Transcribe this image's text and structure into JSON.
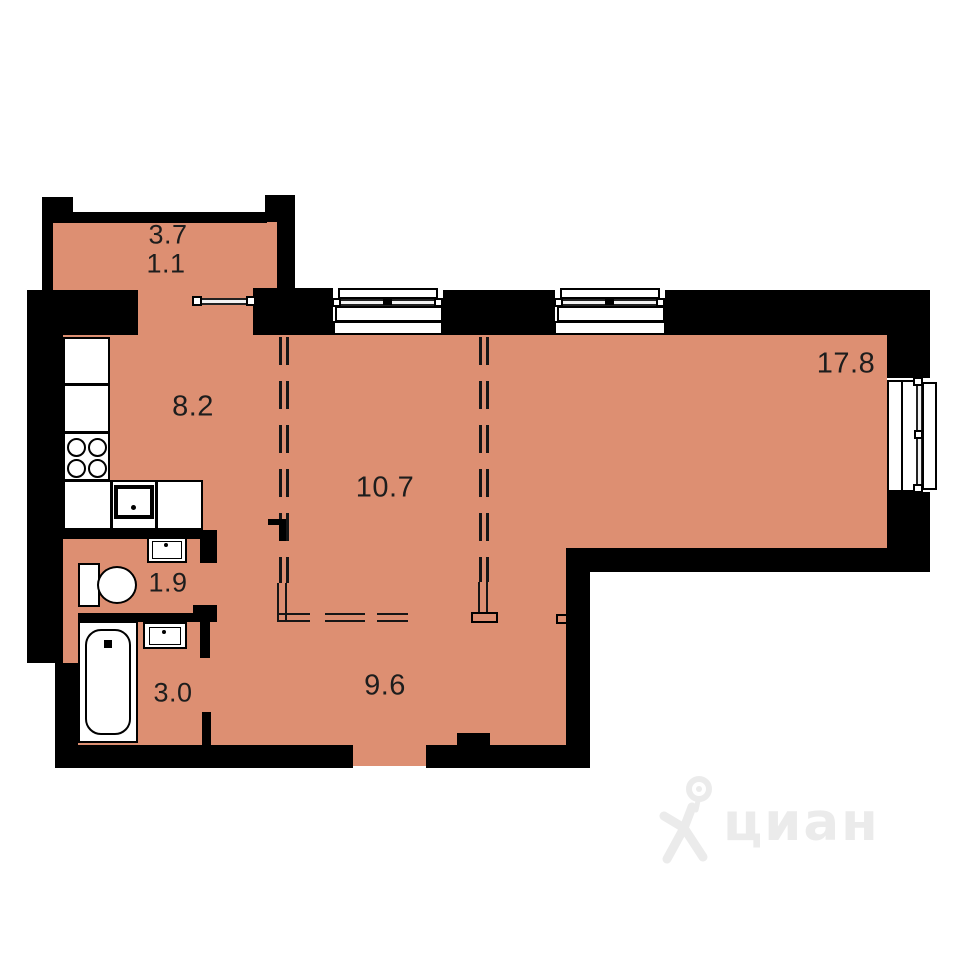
{
  "title": "apartment-floor-plan",
  "colors": {
    "floor": "#DD8F72",
    "wall": "#000000",
    "label": "#1D1D1D",
    "watermark": "#EBEBEB"
  },
  "rooms": {
    "balcony_full": "3.7",
    "balcony_reduced": "1.1",
    "kitchen": "8.2",
    "room": "10.7",
    "living": "17.8",
    "wc": "1.9",
    "bathroom": "3.0",
    "hallway": "9.6"
  },
  "fixtures": [
    "kitchen-cabinet",
    "stove",
    "kitchen-sink",
    "washbasin",
    "toilet",
    "bathtub",
    "window",
    "balcony-door",
    "dashed-partition"
  ],
  "watermark": {
    "brand": "циан"
  }
}
